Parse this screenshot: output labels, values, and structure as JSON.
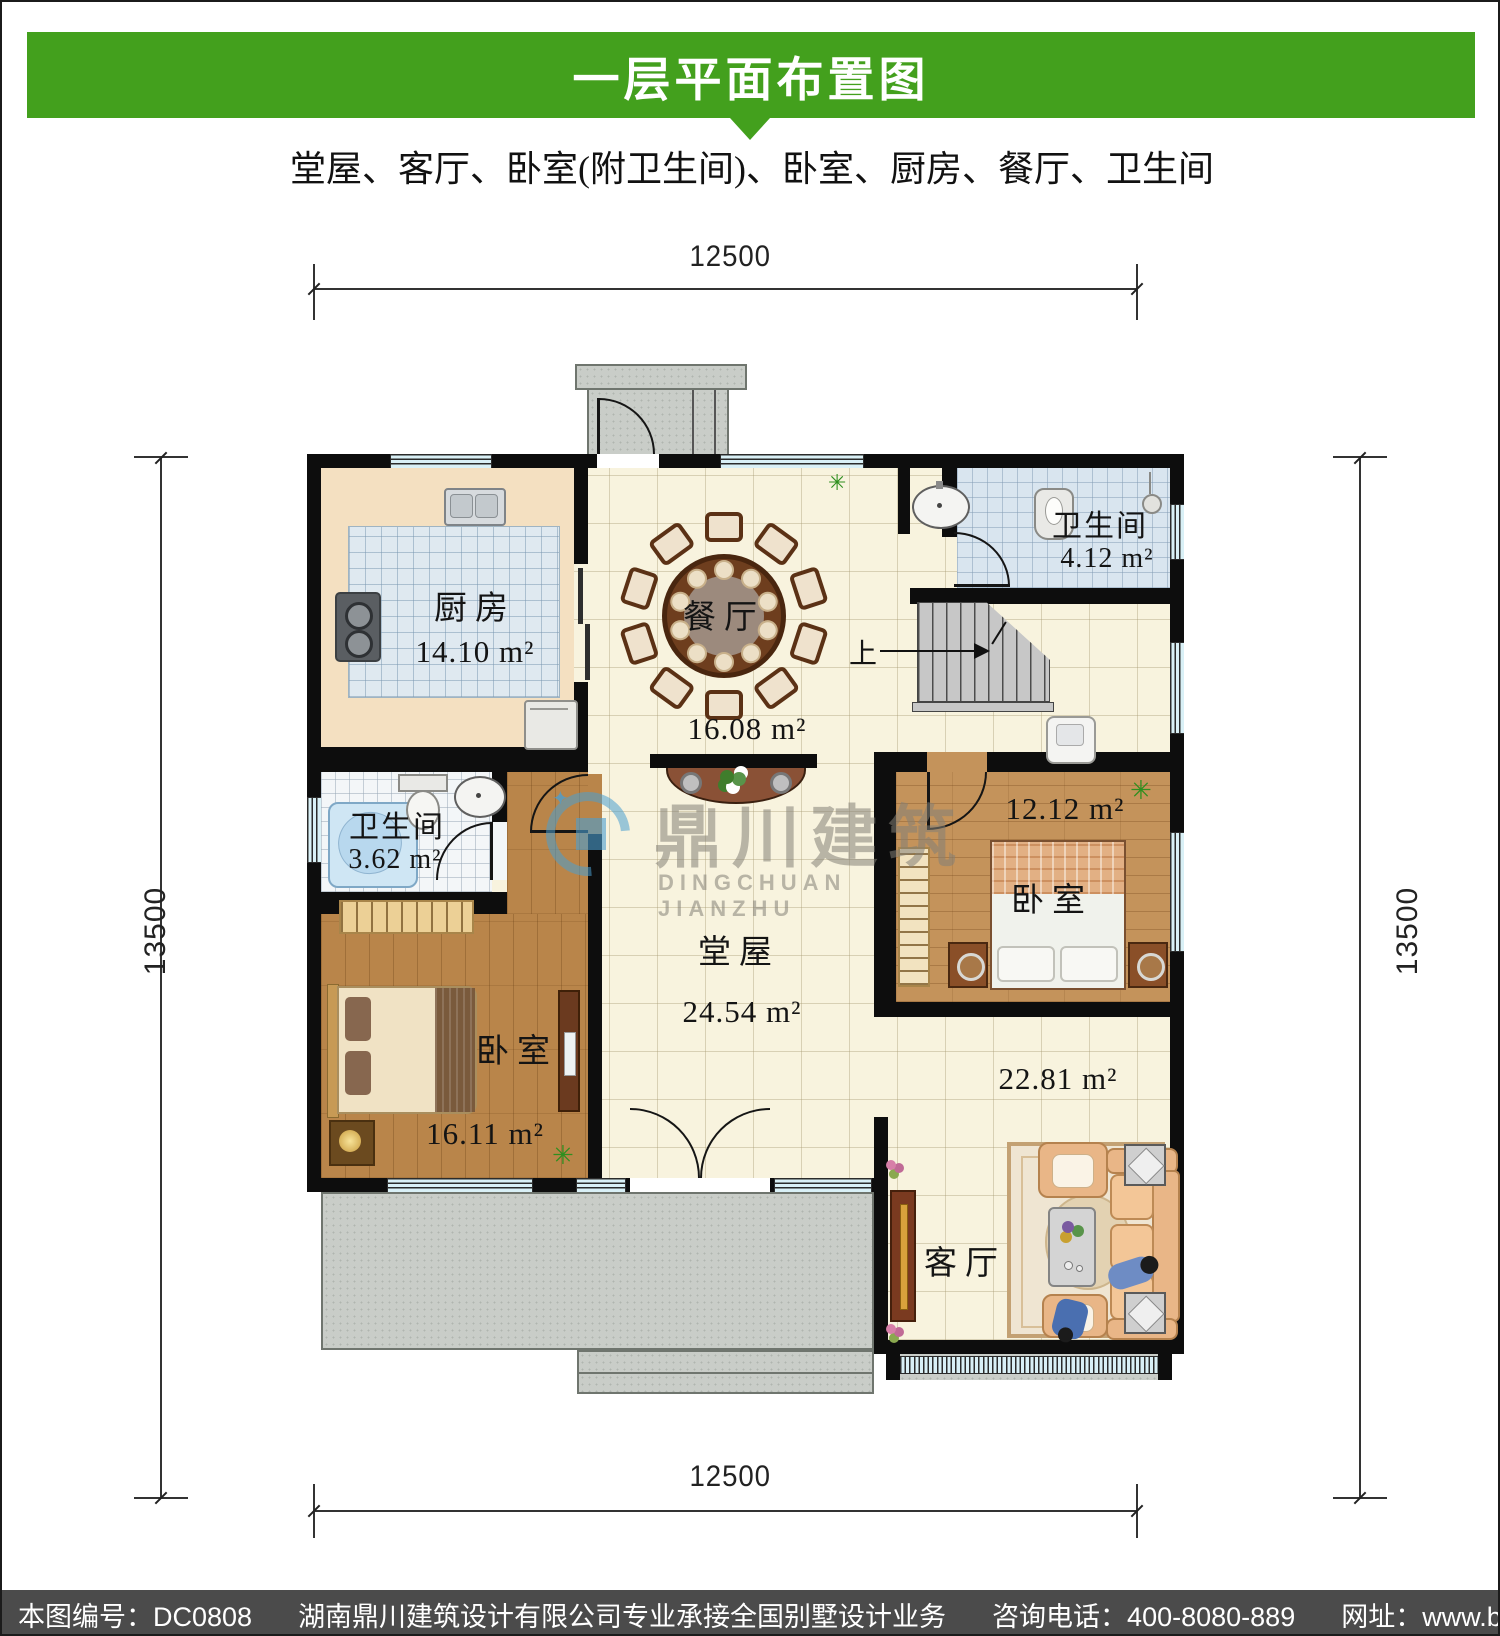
{
  "header": {
    "title": "一层平面布置图",
    "subtitle": "堂屋、客厅、卧室(附卫生间)、卧室、厨房、餐厅、卫生间"
  },
  "dimensions": {
    "top": "12500",
    "bottom": "12500",
    "left": "13500",
    "right": "13500"
  },
  "rooms": {
    "kitchen": {
      "name": "厨房",
      "area": "14.10 m²"
    },
    "dining": {
      "name": "餐厅",
      "area": "16.08 m²"
    },
    "bath_upper": {
      "name": "卫生间",
      "area": "4.12 m²"
    },
    "bath_left": {
      "name": "卫生间",
      "area": "3.62 m²"
    },
    "bedroom_left": {
      "name": "卧室",
      "area": "16.11 m²"
    },
    "hall": {
      "name": "堂屋",
      "area": "24.54 m²"
    },
    "bedroom_right": {
      "name": "卧室",
      "area": "12.12 m²"
    },
    "living": {
      "name": "客厅",
      "area": "22.81 m²"
    }
  },
  "stairs": {
    "up_label": "上"
  },
  "watermark": {
    "cn": "鼎川建筑",
    "en": "DINGCHUAN JIANZHU"
  },
  "footer": {
    "plan_no": "本图编号：DC0808",
    "company": "湖南鼎川建筑设计有限公司专业承接全国别墅设计业务",
    "phone": "咨询电话：400-8080-889",
    "website": "网址：www.bstzcs.com"
  },
  "icons": {
    "plant": "✳"
  },
  "colors": {
    "header_green": "#43a01d",
    "footer_gray": "#4b4b4b",
    "wall_black": "#0d0d0d",
    "window_blue": "#d9f0f6",
    "watermark_blue": "#4b9ed0"
  }
}
